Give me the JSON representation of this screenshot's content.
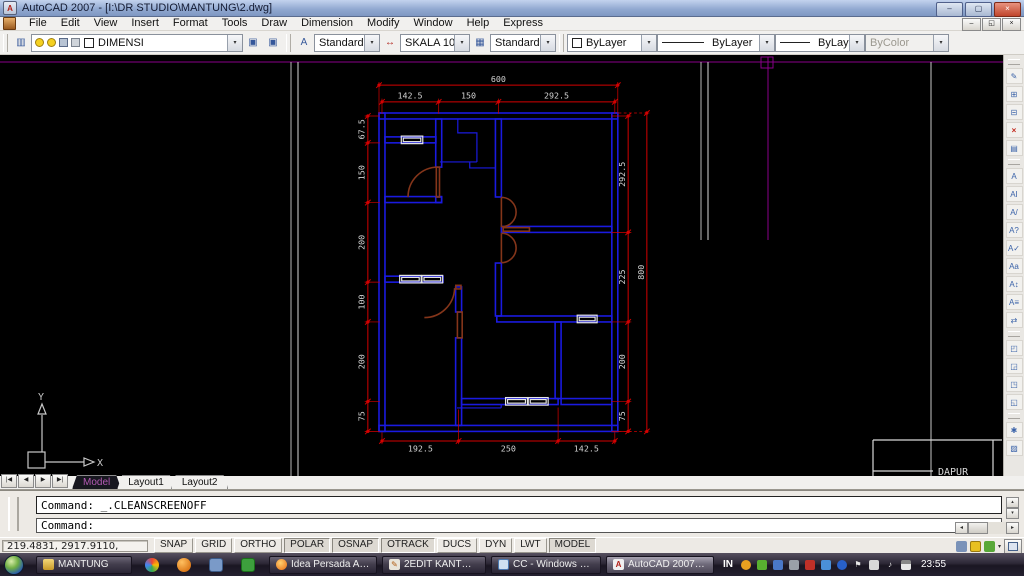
{
  "window": {
    "title": "AutoCAD 2007 - [I:\\DR STUDIO\\MANTUNG\\2.dwg]"
  },
  "menubar": {
    "items": [
      "File",
      "Edit",
      "View",
      "Insert",
      "Format",
      "Tools",
      "Draw",
      "Dimension",
      "Modify",
      "Window",
      "Help",
      "Express"
    ]
  },
  "toolbar": {
    "layer_combo": {
      "value": "DIMENSI"
    },
    "text_style_combo": {
      "value": "Standard"
    },
    "dim_style_combo": {
      "value": "SKALA 100"
    },
    "table_style_combo": {
      "value": "Standard"
    },
    "color_combo": {
      "value": "ByLayer"
    },
    "linetype_combo": {
      "value": "ByLayer"
    },
    "lineweight_combo": {
      "value": "ByLayer"
    },
    "plotstyle_combo": {
      "value": "ByColor"
    }
  },
  "drawing": {
    "dims": {
      "top_total": "600",
      "top_segments": [
        "142.5",
        "150",
        "292.5"
      ],
      "bottom_segments": [
        "192.5",
        "250",
        "142.5"
      ],
      "left_segments": [
        "67.5",
        "150",
        "200",
        "100",
        "200",
        "75"
      ],
      "right_segments": [
        "292.5",
        "225",
        "200",
        "75"
      ],
      "right_total": "800"
    },
    "labels": {
      "room": "DAPUR"
    },
    "ucs": {
      "x_label": "X",
      "y_label": "Y"
    },
    "colors": {
      "wall": "#1a1ae0",
      "dim": "#d40000",
      "dim_text": "#d4d4d4",
      "door": "#84351a",
      "window": "#e6e6e6",
      "overlay": "#8a008a",
      "guide": "#b8b8b8"
    }
  },
  "layout_tabs": {
    "tabs": [
      "Model",
      "Layout1",
      "Layout2"
    ],
    "active": "Model"
  },
  "command": {
    "history": "Command: _.CLEANSCREENOFF",
    "prompt": "Command:"
  },
  "statusbar": {
    "coordinates": "219.4831, 2917.9110, 0.0000",
    "toggles": [
      {
        "label": "SNAP",
        "on": false
      },
      {
        "label": "GRID",
        "on": false
      },
      {
        "label": "ORTHO",
        "on": false
      },
      {
        "label": "POLAR",
        "on": true
      },
      {
        "label": "OSNAP",
        "on": true
      },
      {
        "label": "OTRACK",
        "on": true
      },
      {
        "label": "DUCS",
        "on": false
      },
      {
        "label": "DYN",
        "on": false
      },
      {
        "label": "LWT",
        "on": false
      },
      {
        "label": "MODEL",
        "on": true
      }
    ]
  },
  "right_toolbar": {
    "icons": [
      "edit-reference",
      "add-objects-to-workset",
      "remove-from-workset",
      "close-reference",
      "save-reference-edits",
      "multiline-text",
      "single-line-text",
      "edit-text",
      "find-and-replace",
      "spell-check",
      "text-style",
      "scale-text",
      "justify-text",
      "convert-text",
      "bring-to-front",
      "send-to-back",
      "bring-above-objects",
      "send-under-objects",
      "render-settings",
      "hatch"
    ]
  },
  "taskbar": {
    "items": [
      {
        "label": "MANTUNG",
        "active": false
      },
      {
        "label": "Idea Persada Arch...",
        "active": false
      },
      {
        "label": "2EDIT KANTOR - ...",
        "active": false
      },
      {
        "label": "CC - Windows Ph...",
        "active": false
      },
      {
        "label": "AutoCAD 2007 - [I...",
        "active": true
      }
    ],
    "language": "IN",
    "clock": "23:55",
    "tray_icons": [
      "media-icon",
      "update-icon",
      "network-icon",
      "display-icon",
      "audio-alert-icon",
      "java-icon",
      "bluetooth-icon",
      "flag-icon",
      "battery-icon",
      "volume-icon",
      "signal-icon"
    ]
  }
}
